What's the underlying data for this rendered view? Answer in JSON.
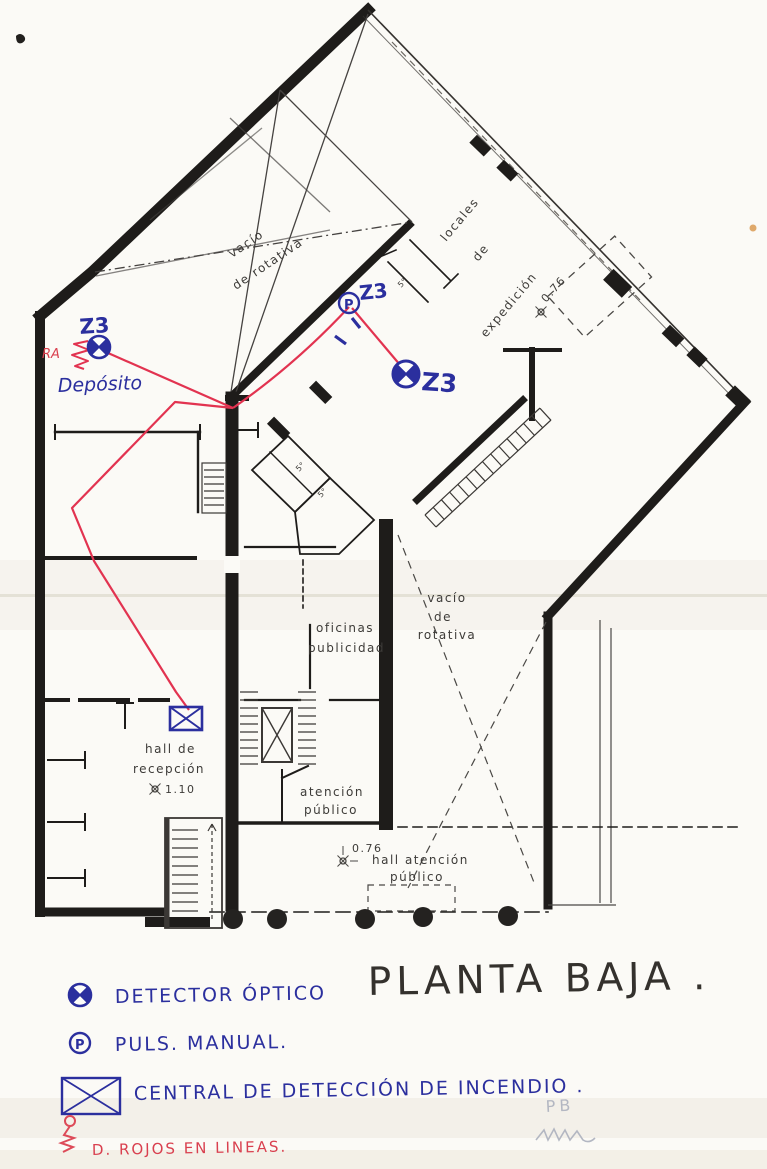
{
  "title": {
    "text": "PLANTA BAJA ."
  },
  "plan_labels": {
    "rotativa_nw": {
      "line1": "vacío",
      "line2": "de rotativa"
    },
    "locales": {
      "line1": "locales",
      "line2": "de",
      "line3": "expedición"
    },
    "expedicion_level": "0.76",
    "oficinas": {
      "line1": "oficinas",
      "line2": "publicidad"
    },
    "rotativa_e": {
      "line1": "vacío",
      "line2": "de",
      "line3": "rotativa"
    },
    "hall_recepcion": {
      "line1": "hall de",
      "line2": "recepción",
      "level": "1.10"
    },
    "atencion": {
      "line1": "atención",
      "line2": "público"
    },
    "hall_atencion": {
      "level": "0.76",
      "line1": "hall atención",
      "line2": "público"
    },
    "room_5_a": "5°",
    "room_5_b": "5°",
    "room_5_c": "5°"
  },
  "ink_annotations": {
    "zone_1": "Z3",
    "zone_2": "Z3",
    "zone_3": "Z3",
    "deposito": "Depósito",
    "ra": "RA",
    "pushbutton_letter": "P"
  },
  "legend": {
    "items": [
      {
        "symbol": "optical-detector",
        "label": "DETECTOR ÓPTICO"
      },
      {
        "symbol": "manual-pushbutton",
        "label": "PULS. MANUAL."
      },
      {
        "symbol": "fire-detection-panel",
        "label": "CENTRAL DE DETECCIÓN DE INCENDIO ."
      },
      {
        "symbol": "red-wiring-run",
        "label": "D. ROJOS EN LINEAS."
      }
    ]
  },
  "pencil_marks": {
    "initials": "PB"
  },
  "colors": {
    "plan_ink": "#1e1c1a",
    "ballpoint_blue": "#2b2f9e",
    "wiring_red": "#e23350",
    "legend_red": "#dd4a58",
    "pencil_gray": "#b3b7c2",
    "paper": "#fbfaf6"
  }
}
